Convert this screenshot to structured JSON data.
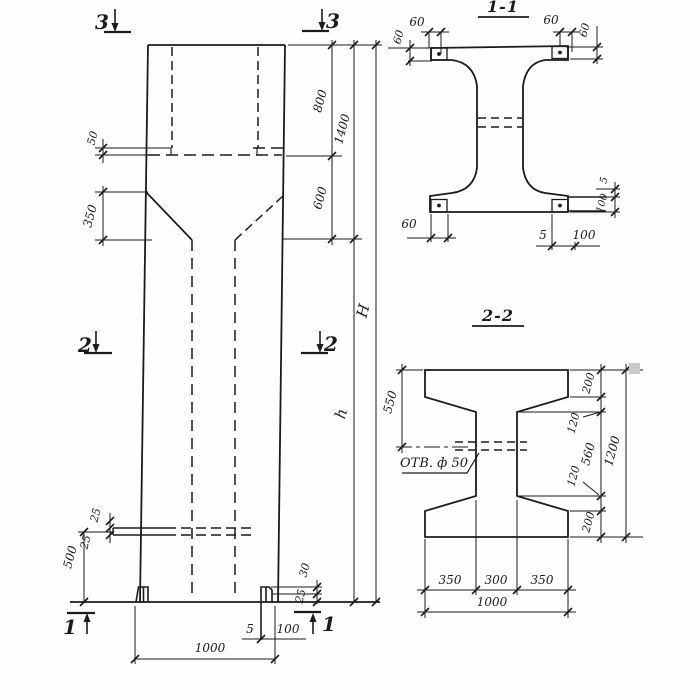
{
  "elevation": {
    "markers": {
      "top_left": "3",
      "top_right": "3",
      "mid_left": "2",
      "mid_right": "2",
      "bottom_left": "1",
      "bottom_right": "1"
    },
    "dims": {
      "ledge": "50",
      "head_taper": "350",
      "recess_depth": "800",
      "neck": "600",
      "head_total": "1400",
      "overall_height": "H",
      "shaft_height": "h",
      "embed_upper": "25",
      "embed_lower": "25",
      "embed_to_base": "500",
      "foot_upper": "30",
      "foot_lower": "25",
      "base_plate_thickness": "5",
      "base_plate_width": "100",
      "column_width": "1000"
    }
  },
  "section_1_1": {
    "title": "1-1",
    "dims": {
      "top_left_h": "60",
      "top_left_v": "60",
      "top_right_h": "60",
      "top_right_v": "60",
      "bottom_left": "60",
      "right_offset": "5",
      "right_plate": "100",
      "bottom_offset": "5",
      "bottom_plate": "100"
    }
  },
  "section_2_2": {
    "title": "2-2",
    "hole_label": "ОТВ. ф 50",
    "dims": {
      "flange_to_hole": "550",
      "top_flange": "200",
      "top_haunch": "120",
      "web_height": "560",
      "bottom_haunch": "120",
      "bottom_flange": "200",
      "section_height": "1200",
      "bottom_left": "350",
      "bottom_mid": "300",
      "bottom_right": "350",
      "bottom_total": "1000"
    }
  }
}
